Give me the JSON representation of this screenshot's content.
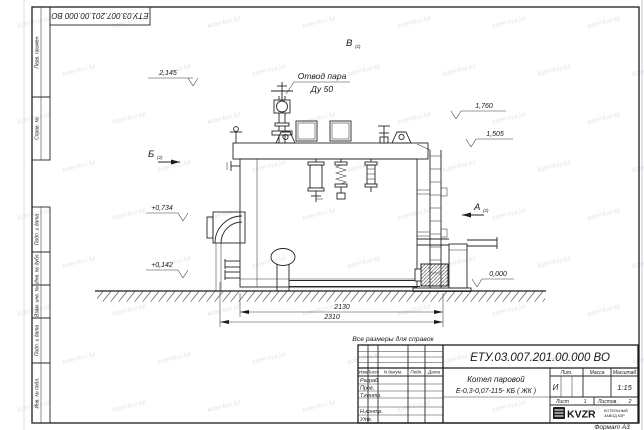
{
  "page": {
    "format": "Формат А3",
    "watermark": "kotel-kvz.kz"
  },
  "frame": {
    "top_stamp_doc_number": "ЕТУ.03.007.201.00.000  ВО",
    "side_columns": [
      "Перв. примен.",
      "Справ. №",
      "Подп. и дата",
      "Инв. № дубл.",
      "Взам. инв. №",
      "Подп. и дата",
      "Инв. № подл."
    ]
  },
  "drawing": {
    "note": "Все размеры для справок",
    "steam_outlet": {
      "line1": "Отвод пара",
      "line2": "Ду 50"
    },
    "views": {
      "a": "А",
      "b": "Б",
      "v": "В",
      "sheet_ref": "(2)"
    },
    "elevations": {
      "e2145": "2,145",
      "e1760": "1,760",
      "e1505": "1,505",
      "e0734": "+0,734",
      "e0142": "+0,142",
      "e0000": "0,000"
    },
    "dimensions": {
      "d2130": "2130",
      "d2310": "2310"
    }
  },
  "title_block": {
    "doc_number": "ЕТУ.03.007.201.00.000  ВО",
    "product_name_line1": "Котел паровой",
    "product_name_line2": "Е-0,3-0,07-115- КБ ( ЖК )",
    "columns": {
      "izm": "Изм",
      "list": "Лист",
      "doc": "N докум.",
      "podp": "Подп.",
      "data": "Дата"
    },
    "roles": {
      "razrab": "Разраб.",
      "prov": "Пров.",
      "tkontr": "Т.контр.",
      "nkontr": "Н.контр.",
      "utv": "Утв."
    },
    "lit": {
      "label": "Лит.",
      "value": "И"
    },
    "massa": {
      "label": "Масса"
    },
    "scale": {
      "label": "Масштаб",
      "value": "1:15"
    },
    "sheet": {
      "label": "Лист",
      "value": "1"
    },
    "sheets": {
      "label": "Листов",
      "value": "2"
    },
    "company": {
      "logo": "KVZR",
      "sub1": "КОТЕЛЬНЫЙ",
      "sub2": "ЗАВОД КЗР"
    }
  }
}
